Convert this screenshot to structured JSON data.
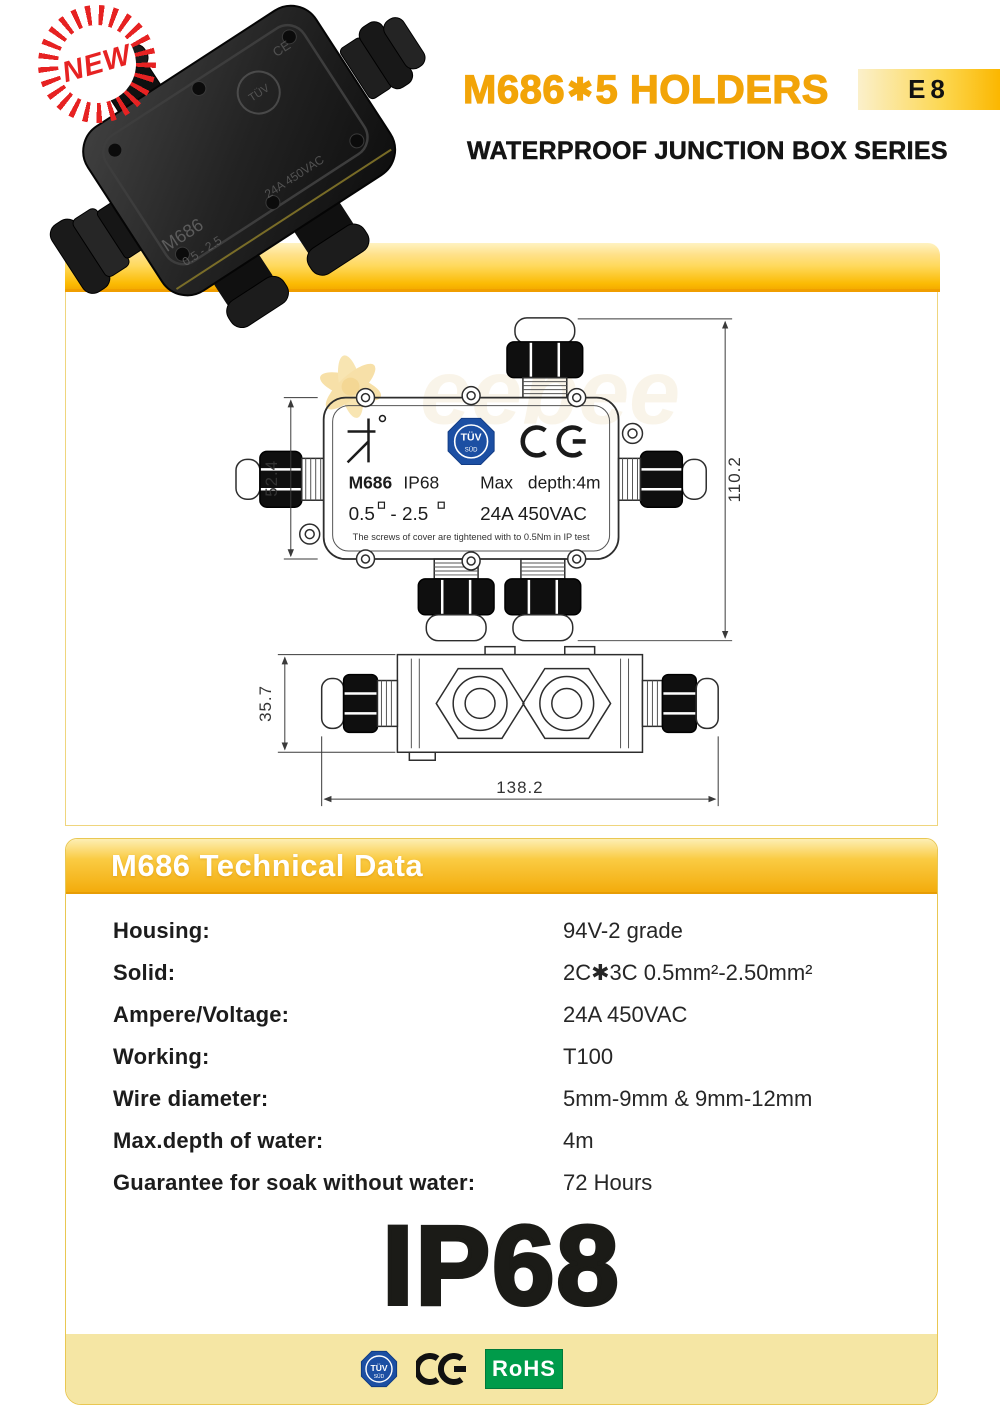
{
  "header": {
    "new_badge": "NEW",
    "title_model": "M686",
    "title_star": "✱",
    "title_rest": "5 HOLDERS",
    "subtitle": "WATERPROOF JUNCTION BOX SERIES",
    "page_code": "E8"
  },
  "photo": {
    "marking_model": "M686",
    "marking_range": "0.5 - 2.5",
    "marking_rating": "24A 450VAC",
    "marking_tuv": "TÜV",
    "marking_ce": "CE"
  },
  "drawing": {
    "dims": {
      "box_height": "52.4",
      "overall_height": "110.2",
      "side_height": "35.7",
      "overall_width": "138.2"
    },
    "label": {
      "tuv_top": "TÜV",
      "tuv_bottom": "SÜD",
      "model": "M686",
      "ip": "IP68",
      "max": "Max",
      "depth": "depth:4m",
      "range_a": "0.5",
      "range_b": "- 2.5",
      "rating": "24A 450VAC",
      "note": "The screws of cover are tightened with to 0.5Nm in IP test"
    },
    "watermark": "eebee"
  },
  "tech": {
    "header": "M686 Technical Data",
    "rows": [
      {
        "label": "Housing:",
        "value": "94V-2 grade"
      },
      {
        "label": "Solid:",
        "value": "2C✱3C  0.5mm²-2.50mm²"
      },
      {
        "label": "Ampere/Voltage:",
        "value": "24A  450VAC"
      },
      {
        "label": "Working:",
        "value": "T100"
      },
      {
        "label": "Wire diameter:",
        "value": "5mm-9mm & 9mm-12mm"
      },
      {
        "label": "Max.depth of water:",
        "value": "4m"
      },
      {
        "label": "Guarantee for soak without water:",
        "value": "72 Hours"
      }
    ],
    "ip_rating": "IP68"
  },
  "footer": {
    "tuv_top": "TÜV",
    "tuv_bottom": "SÜD",
    "rohs": "RoHS"
  },
  "colors": {
    "accent_orange": "#F2A408",
    "bar_yellow": "#FBBA00",
    "pale_band": "#F5E6A4",
    "rohs_green": "#009B4A",
    "tuv_blue": "#1C4FA3",
    "new_red": "#E62222"
  }
}
